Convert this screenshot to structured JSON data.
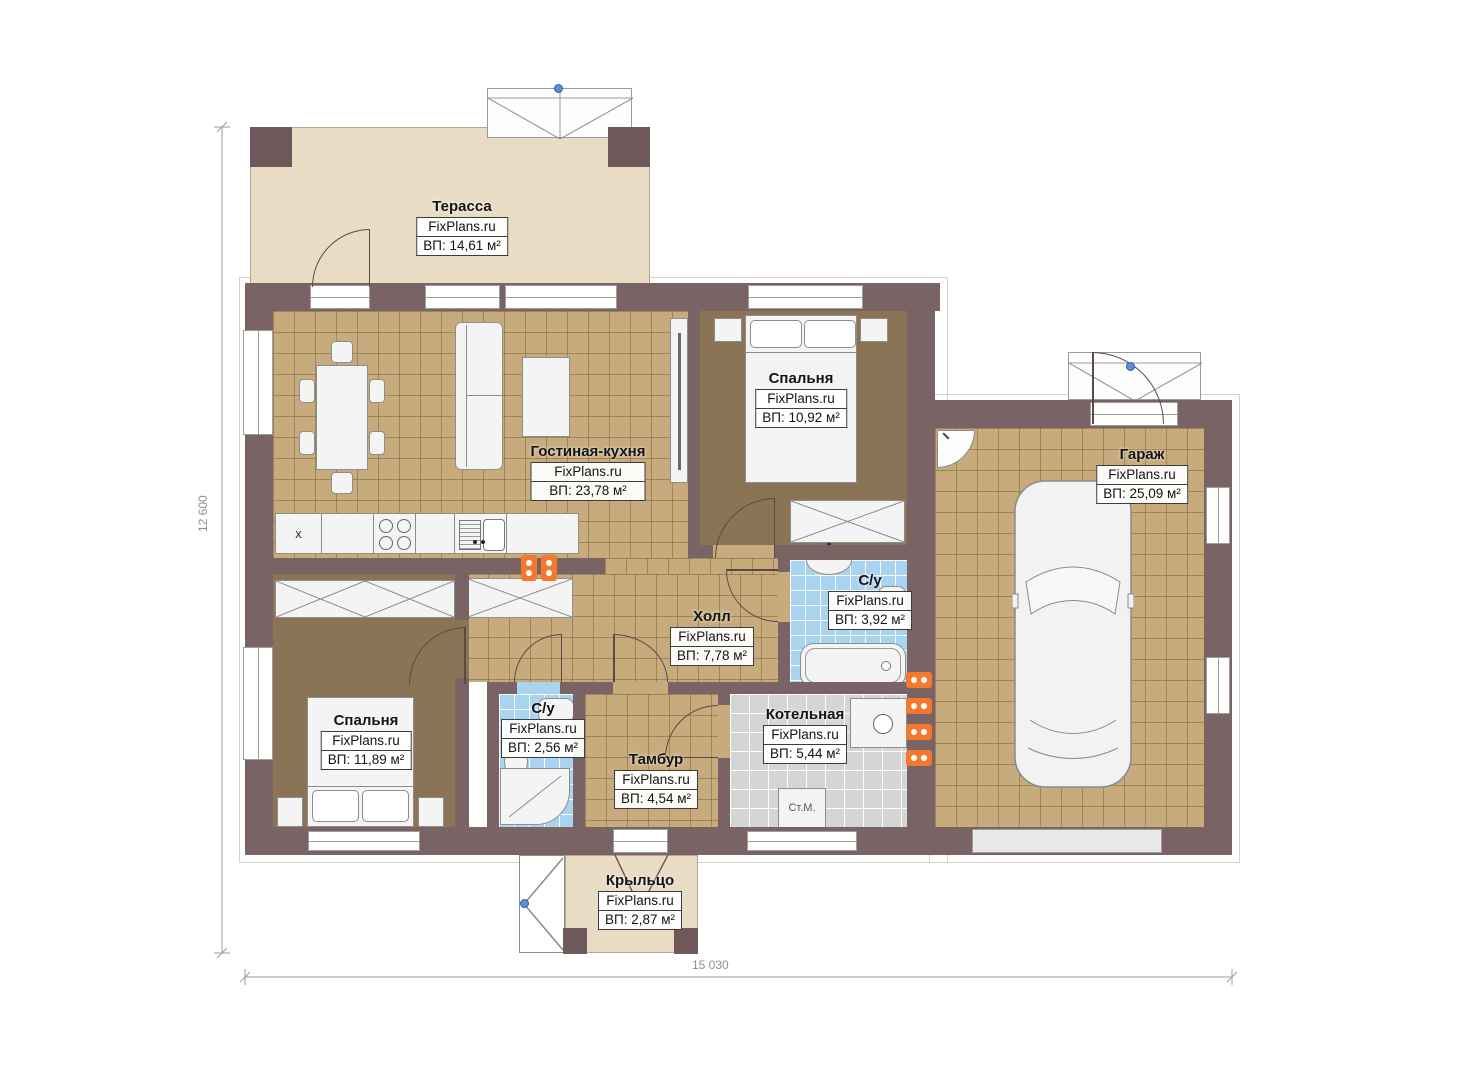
{
  "plan": {
    "watermark": "FixPlans.ru",
    "dimensions": {
      "height_label": "12 600",
      "width_label": "15 030"
    },
    "rooms": [
      {
        "id": "terrace",
        "name": "Терасса",
        "watermark": "FixPlans.ru",
        "area": "ВП: 14,61 м²"
      },
      {
        "id": "living-kitchen",
        "name": "Гостиная-кухня",
        "watermark": "FixPlans.ru",
        "area": "ВП: 23,78 м²"
      },
      {
        "id": "bedroom-1",
        "name": "Спальня",
        "watermark": "FixPlans.ru",
        "area": "ВП: 10,92 м²"
      },
      {
        "id": "garage",
        "name": "Гараж",
        "watermark": "FixPlans.ru",
        "area": "ВП: 25,09 м²"
      },
      {
        "id": "bathroom-1",
        "name": "С/у",
        "watermark": "FixPlans.ru",
        "area": "ВП: 3,92 м²"
      },
      {
        "id": "hall",
        "name": "Холл",
        "watermark": "FixPlans.ru",
        "area": "ВП: 7,78 м²"
      },
      {
        "id": "boiler-room",
        "name": "Котельная",
        "watermark": "FixPlans.ru",
        "area": "ВП: 5,44 м²"
      },
      {
        "id": "vestibule",
        "name": "Тамбур",
        "watermark": "FixPlans.ru",
        "area": "ВП: 4,54 м²"
      },
      {
        "id": "bedroom-2",
        "name": "Спальня",
        "watermark": "FixPlans.ru",
        "area": "ВП: 11,89 м²"
      },
      {
        "id": "bathroom-2",
        "name": "С/у",
        "watermark": "FixPlans.ru",
        "area": "ВП: 2,56 м²"
      },
      {
        "id": "porch",
        "name": "Крыльцо",
        "watermark": "FixPlans.ru",
        "area": "ВП: 2,87 м²"
      }
    ],
    "appliances": {
      "washing_machine": "Ст.М.",
      "fridge_mark": "x"
    },
    "colors": {
      "wall": "#7a6365",
      "floor_tile": "#c7ab7d",
      "bedroom_floor": "#8b7356",
      "bathroom_tile": "#a9d4f0",
      "boiler_tile": "#d5d5d5",
      "terrace": "#e9dcc4",
      "radiator": "#f4792e",
      "marker": "#5b8fd6"
    }
  }
}
